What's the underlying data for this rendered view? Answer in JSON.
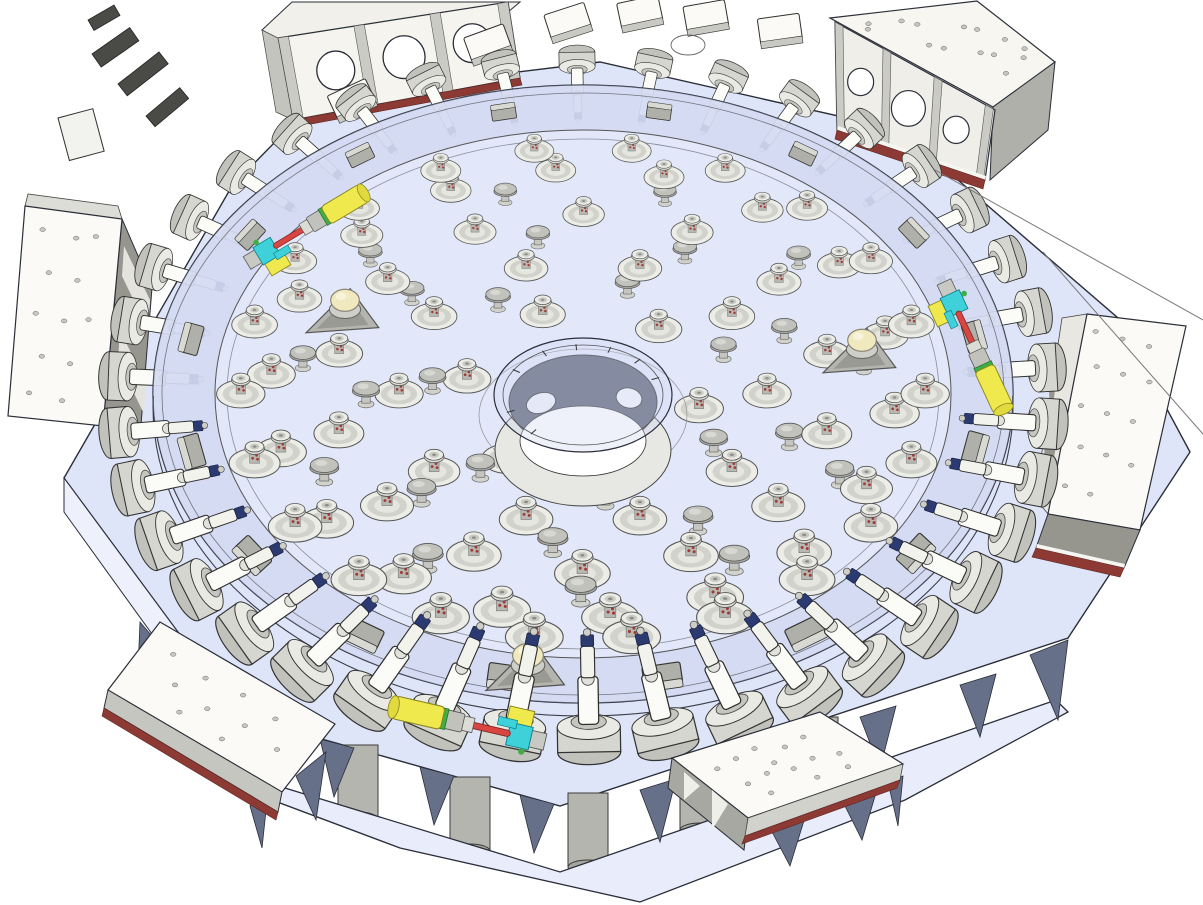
{
  "description": "Isometric 3D CAD rendering of a telescope primary-mirror support cell: a transparent circular mirror blank with a central hub rests on an octagonal base weldment, carried by rings of axial whiffletree supports, perimeter lateral-support actuators, white electronics cabinets and mount plates, with three color-highlighted hardpoint actuators.",
  "canvas": {
    "width": 1203,
    "height": 905,
    "background": "#ffffff"
  },
  "colors": {
    "outline": "#2a2e38",
    "baseTop": "#dfe5f9",
    "baseSide": "#eef1fc",
    "skirt": "#e9edfb",
    "gusset": "#667089",
    "disc": "#e3e9fa",
    "discBand": "#c6cde8",
    "boxWhite": "#fbfaf6",
    "boxMid": "#d2d2cc",
    "boxShadow": "#96968f",
    "redStrip": "#8e3a34",
    "puckLight": "#ededе8",
    "puckMid": "#d2d2cd",
    "puckDark": "#b8b8b3",
    "speckle": "#a23a34",
    "hubDark": "#5d6477",
    "hubLight": "#e7e7e3",
    "yellow": "#efe94d",
    "cyan": "#3fd1da",
    "red": "#d94540",
    "green": "#3fae46",
    "navy": "#2c3a72",
    "cream": "#f0e9c0",
    "legGray": "#b5b5b0"
  },
  "base": {
    "name": "octagonal-base-weldment",
    "leg_count": 5,
    "gusset_count": 9
  },
  "disc": {
    "name": "mirror-blank",
    "cx": 583,
    "cy": 394,
    "rx": 430,
    "ry": 309,
    "band_inner_rx": 368,
    "band_inner_ry": 264,
    "edge_offset": 13
  },
  "hub": {
    "name": "central-hub",
    "cx": 583,
    "cy": 397,
    "outer_rx": 89,
    "outer_ry": 57,
    "oval_hole_count": 2,
    "tick_count": 8
  },
  "axial_supports": {
    "total": 97,
    "rings": [
      {
        "type": "capped",
        "frac": 0.32,
        "count": 6,
        "phase": 10
      },
      {
        "type": "plain",
        "frac": 0.41,
        "count": 7,
        "phase": 30
      },
      {
        "type": "capped",
        "frac": 0.5,
        "count": 10,
        "phase": 0
      },
      {
        "type": "plain",
        "frac": 0.59,
        "count": 9,
        "phase": 18
      },
      {
        "type": "capped",
        "frac": 0.68,
        "count": 14,
        "phase": 13
      },
      {
        "type": "plain",
        "frac": 0.77,
        "count": 11,
        "phase": 25
      },
      {
        "type": "capped",
        "frac": 0.85,
        "count": 18,
        "phase": 5
      },
      {
        "type": "capped",
        "frac": 0.93,
        "count": 22,
        "phase": 0
      }
    ]
  },
  "hardpoints": {
    "count": 3,
    "positions": [
      {
        "x": 345,
        "y": 312,
        "s": 1.3
      },
      {
        "x": 862,
        "y": 352,
        "s": 1.3
      },
      {
        "x": 528,
        "y": 668,
        "s": 1.4
      }
    ]
  },
  "lateral_supports": {
    "count": 38,
    "ring_rx": 468,
    "ring_ry": 342
  },
  "rim_clamps": {
    "count": 16,
    "ring_rx": 398,
    "ring_ry": 287
  },
  "highlighted_actuators": {
    "count": 3,
    "instances": [
      {
        "x": 247,
        "y": 263,
        "rot": -31,
        "s": 0.92
      },
      {
        "x": 944,
        "y": 282,
        "rot": 65,
        "s": 0.95
      },
      {
        "x": 545,
        "y": 742,
        "rot": 193,
        "s": 1.05
      }
    ]
  },
  "cabinets": [
    {
      "id": "cabinet-top-left",
      "style": "ported-panel-3-holes"
    },
    {
      "id": "cabinet-top-right",
      "style": "ported-box-3-holes"
    },
    {
      "id": "cabinet-left",
      "style": "bolted-slab"
    },
    {
      "id": "cabinet-right",
      "style": "bolted-slab"
    },
    {
      "id": "mount-plate-bottom-left",
      "style": "gusseted-plate"
    },
    {
      "id": "mount-plate-bottom-right",
      "style": "gusseted-plate"
    }
  ],
  "far_boxes": {
    "count": 6
  }
}
